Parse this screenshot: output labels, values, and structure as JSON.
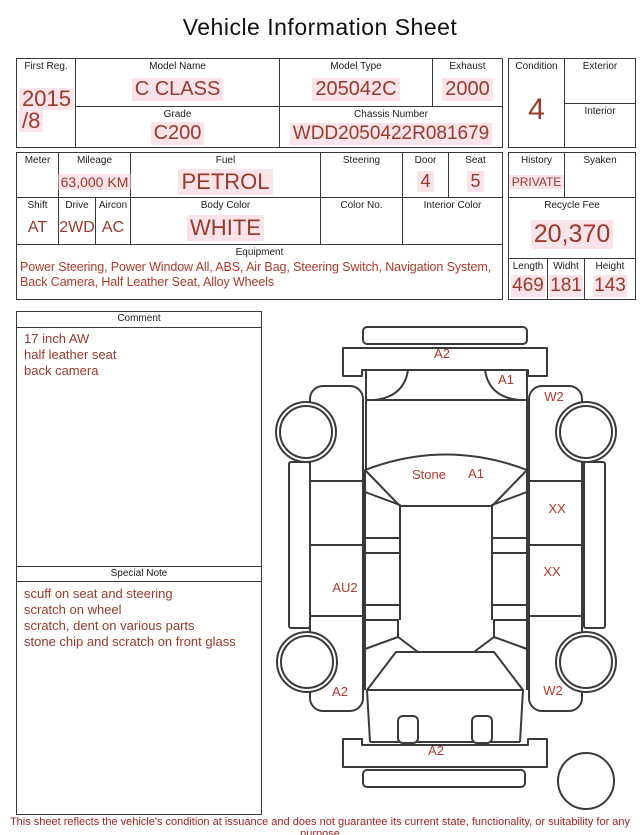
{
  "title": "Vehicle Information Sheet",
  "table1": {
    "first_reg": {
      "label": "First Reg.",
      "value_line1": "2015",
      "value_line2": "/8"
    },
    "model_name": {
      "label": "Model Name",
      "value": "C CLASS"
    },
    "model_type": {
      "label": "Model Type",
      "value": "205042C"
    },
    "exhaust": {
      "label": "Exhaust",
      "value": "2000"
    },
    "grade": {
      "label": "Grade",
      "value": "C200"
    },
    "chassis_number": {
      "label": "Chassis Number",
      "value": "WDD2050422R081679"
    },
    "condition": {
      "label": "Condition",
      "value": "4"
    },
    "exterior": {
      "label": "Exterior",
      "value": ""
    },
    "interior": {
      "label": "Interior",
      "value": ""
    }
  },
  "table2": {
    "meter": {
      "label": "Meter",
      "value": ""
    },
    "mileage": {
      "label": "Mileage",
      "value": "63,000 KM"
    },
    "fuel": {
      "label": "Fuel",
      "value": "PETROL"
    },
    "steering": {
      "label": "Steering",
      "value": ""
    },
    "door": {
      "label": "Door",
      "value": "4"
    },
    "seat": {
      "label": "Seat",
      "value": "5"
    },
    "shift": {
      "label": "Shift",
      "value": "AT"
    },
    "drive": {
      "label": "Drive",
      "value": "2WD"
    },
    "aircon": {
      "label": "Aircon",
      "value": "AC"
    },
    "body_color": {
      "label": "Body Color",
      "value": "WHITE"
    },
    "color_no": {
      "label": "Color No.",
      "value": ""
    },
    "interior_color": {
      "label": "Interior Color",
      "value": ""
    },
    "equipment": {
      "label": "Equipment",
      "value": "Power Steering, Power Window  All, ABS, Air Bag, Steering Switch, Navigation System, Back Camera, Half Leather Seat, Alloy Wheels"
    },
    "history": {
      "label": "History",
      "value": "PRIVATE"
    },
    "syaken": {
      "label": "Syaken",
      "value": ""
    },
    "recycle_fee": {
      "label": "Recycle Fee",
      "value": "20,370"
    },
    "length": {
      "label": "Length",
      "value": "469"
    },
    "widht": {
      "label": "Widht",
      "value": "181"
    },
    "height": {
      "label": "Height",
      "value": "143"
    }
  },
  "comment": {
    "label": "Comment",
    "line1": "17 inch AW",
    "line2": "half leather seat",
    "line3": "back camera"
  },
  "special_note": {
    "label": "Special Note",
    "line1": "scuff on seat and steering",
    "line2": "scratch on wheel",
    "line3": "scratch, dent on various parts",
    "line4": "stone chip and scratch on front glass"
  },
  "diagram": {
    "labels": [
      "A2",
      "A1",
      "W2",
      "Stone",
      "A1",
      "XX",
      "XX",
      "AU2",
      "A2",
      "W2",
      "A2"
    ]
  },
  "footer": "This sheet reflects the vehicle's condition at issuance and does not guarantee its current state, functionality, or suitability for any purpose",
  "colors": {
    "value_red": "#993a2a",
    "diagram_red": "#b4392c",
    "footer_red": "#a32424",
    "highlight_pink": "#f6ccd7",
    "border": "#3a3a3a"
  }
}
